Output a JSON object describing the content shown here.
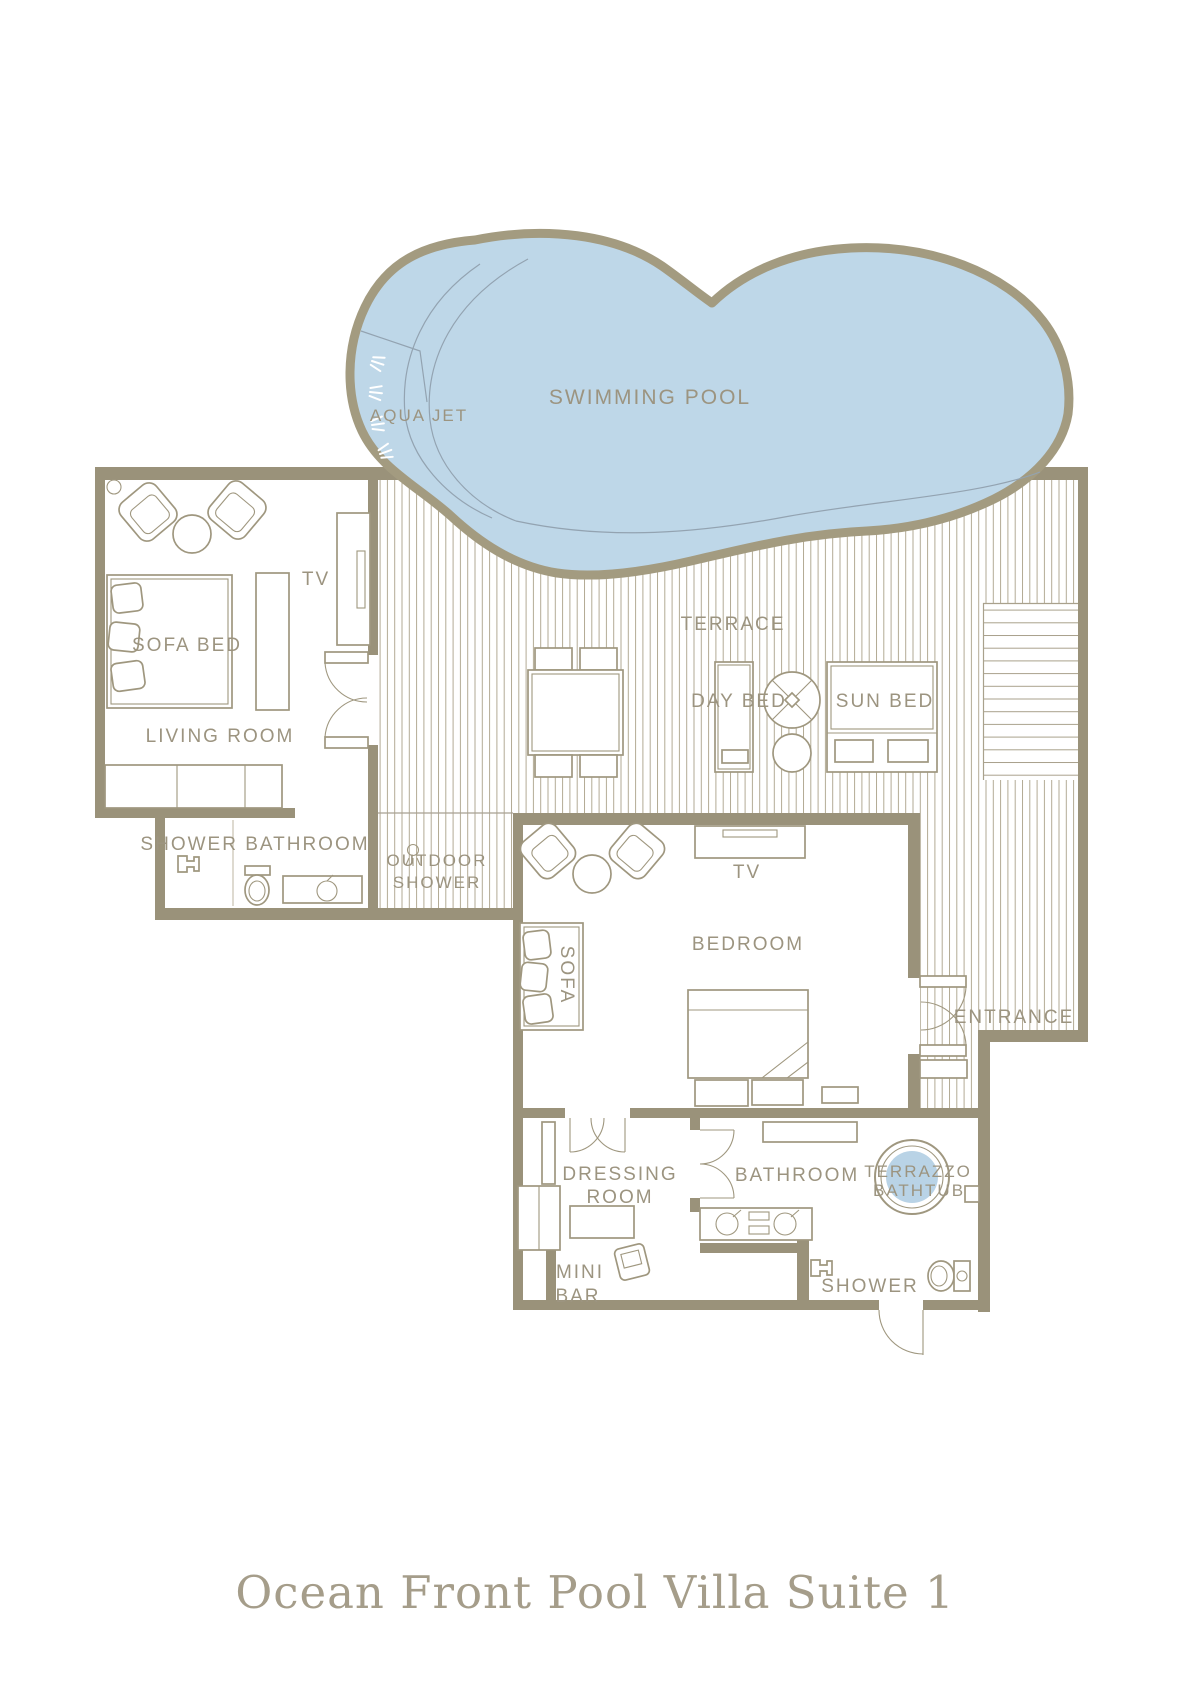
{
  "title": "Ocean Front Pool Villa Suite 1",
  "pool": {
    "label": "SWIMMING POOL",
    "aqua_jet_label": "AQUA JET"
  },
  "terrace": {
    "label": "TERRACE",
    "day_bed_label": "DAY BED",
    "sun_bed_label": "SUN BED"
  },
  "living_room": {
    "label": "LIVING ROOM",
    "sofa_bed_label": "SOFA BED",
    "tv_label": "TV"
  },
  "shower_bathroom": {
    "label": "SHOWER BATHROOM"
  },
  "outdoor_shower": {
    "label_line1": "OUTDOOR",
    "label_line2": "SHOWER"
  },
  "bedroom": {
    "label": "BEDROOM",
    "tv_label": "TV",
    "sofa_label": "SOFA"
  },
  "entrance": {
    "label": "ENTRANCE"
  },
  "dressing_room": {
    "label_line1": "DRESSING",
    "label_line2": "ROOM"
  },
  "mini_bar": {
    "label_line1": "MINI",
    "label_line2": "BAR"
  },
  "bathroom": {
    "label": "BATHROOM",
    "bathtub_label_line1": "TERRAZZO",
    "bathtub_label_line2": "BATHTUB"
  },
  "shower_room": {
    "label": "SHOWER"
  },
  "colors": {
    "wall": "#9a927a",
    "pool_fill": "#bed7e8",
    "pool_outline": "#a39b80",
    "water_line": "#93a3b1",
    "furniture_line": "#9f977f",
    "hatch_line": "#b2aa94",
    "label_text": "#9c9480",
    "title_text": "#a59d8a"
  }
}
